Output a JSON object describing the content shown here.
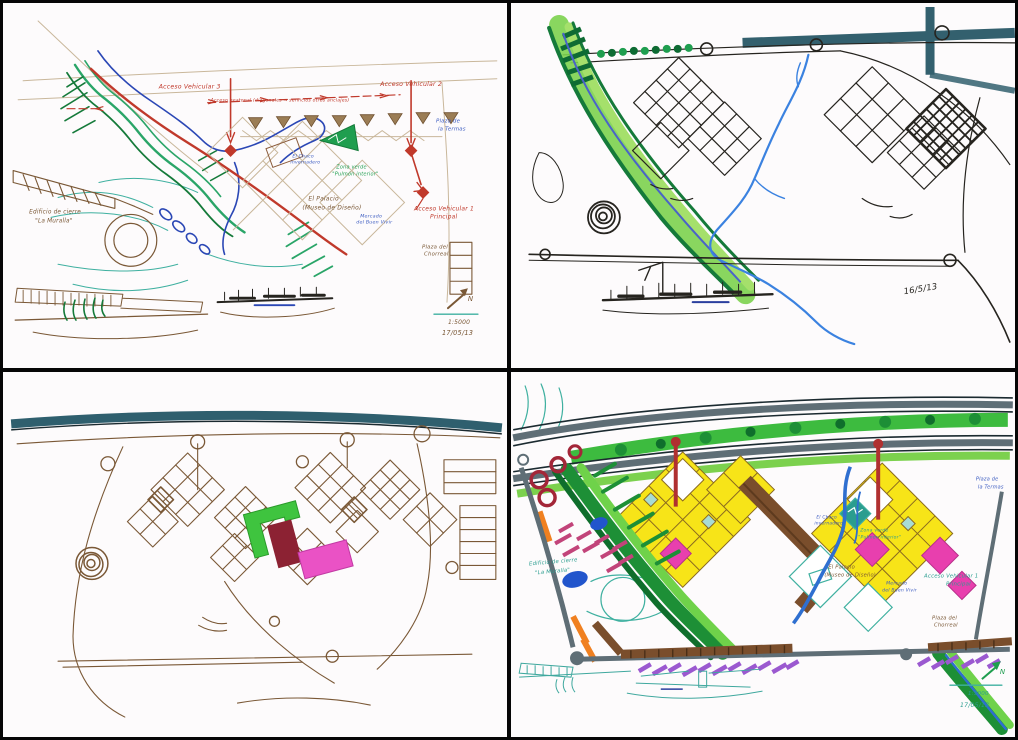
{
  "palette": {
    "paper": "#fdfbfc",
    "frame": "#060606",
    "marker_green_light": "#7cd14e",
    "marker_green_dark": "#157a3a",
    "river_blue": "#3b82e0",
    "band_teal": "#33606e",
    "building_yellow": "#f7e418",
    "accent_magenta": "#e84fc0",
    "accent_dark_red": "#8c2233",
    "ink_sepia": "#7a5836",
    "route_red": "#c0392b",
    "hatch_purple": "#9b59d0",
    "accent_orange": "#f08020",
    "road_gray": "#5f6e76"
  },
  "panels": [
    {
      "id": "plan-lineart-color",
      "labels": {
        "av3": "Acceso Vehicular 3",
        "av2": "Acceso Vehicular 2",
        "peatonal": "Acceso peatonal (diagonales → servicios otros anclajes)",
        "av1a": "Acceso Vehicular 1",
        "av1b": "Principal",
        "termas_a": "Plaza de",
        "termas_b": "la Termas",
        "chaco_a": "El Chaco",
        "chaco_b": "invernadero",
        "zverde_a": "Zona verde",
        "zverde_b": "\"Pulmón interior\"",
        "palacio_a": "El Palacio",
        "palacio_b": "(Museo de Diseño)",
        "mercado_a": "Mercado",
        "mercado_b": "del Buen Vivir",
        "cierre_a": "Edificio de cierre",
        "cierre_b": "\"La Muralla\"",
        "chorreal_a": "Plaza del",
        "chorreal_b": "Chorreal",
        "scale": "1:5000",
        "date": "17/05/13",
        "north": "N"
      }
    },
    {
      "id": "plan-ink-marker",
      "labels": {
        "date": "16/5/13"
      }
    },
    {
      "id": "plan-sepia",
      "labels": {}
    },
    {
      "id": "plan-full-color",
      "labels": {
        "cierre_a": "Edificio de cierre",
        "cierre_b": "\"La Muralla\"",
        "termas_a": "Plaza de",
        "termas_b": "la Termas",
        "chaco_a": "El Chaco",
        "chaco_b": "invernadero",
        "zverde_a": "Zona verde",
        "zverde_b": "\"Pulmón interior\"",
        "palacio_a": "El Palacio",
        "palacio_b": "(Museo de Diseño)",
        "mercado_a": "Mercado",
        "mercado_b": "del Buen Vivir",
        "av1a": "Acceso Vehicular 1",
        "av1b": "Principal",
        "chorreal_a": "Plaza del",
        "chorreal_b": "Chorreal",
        "scale": "1:5000",
        "date": "17/05/13",
        "north": "N"
      }
    }
  ]
}
